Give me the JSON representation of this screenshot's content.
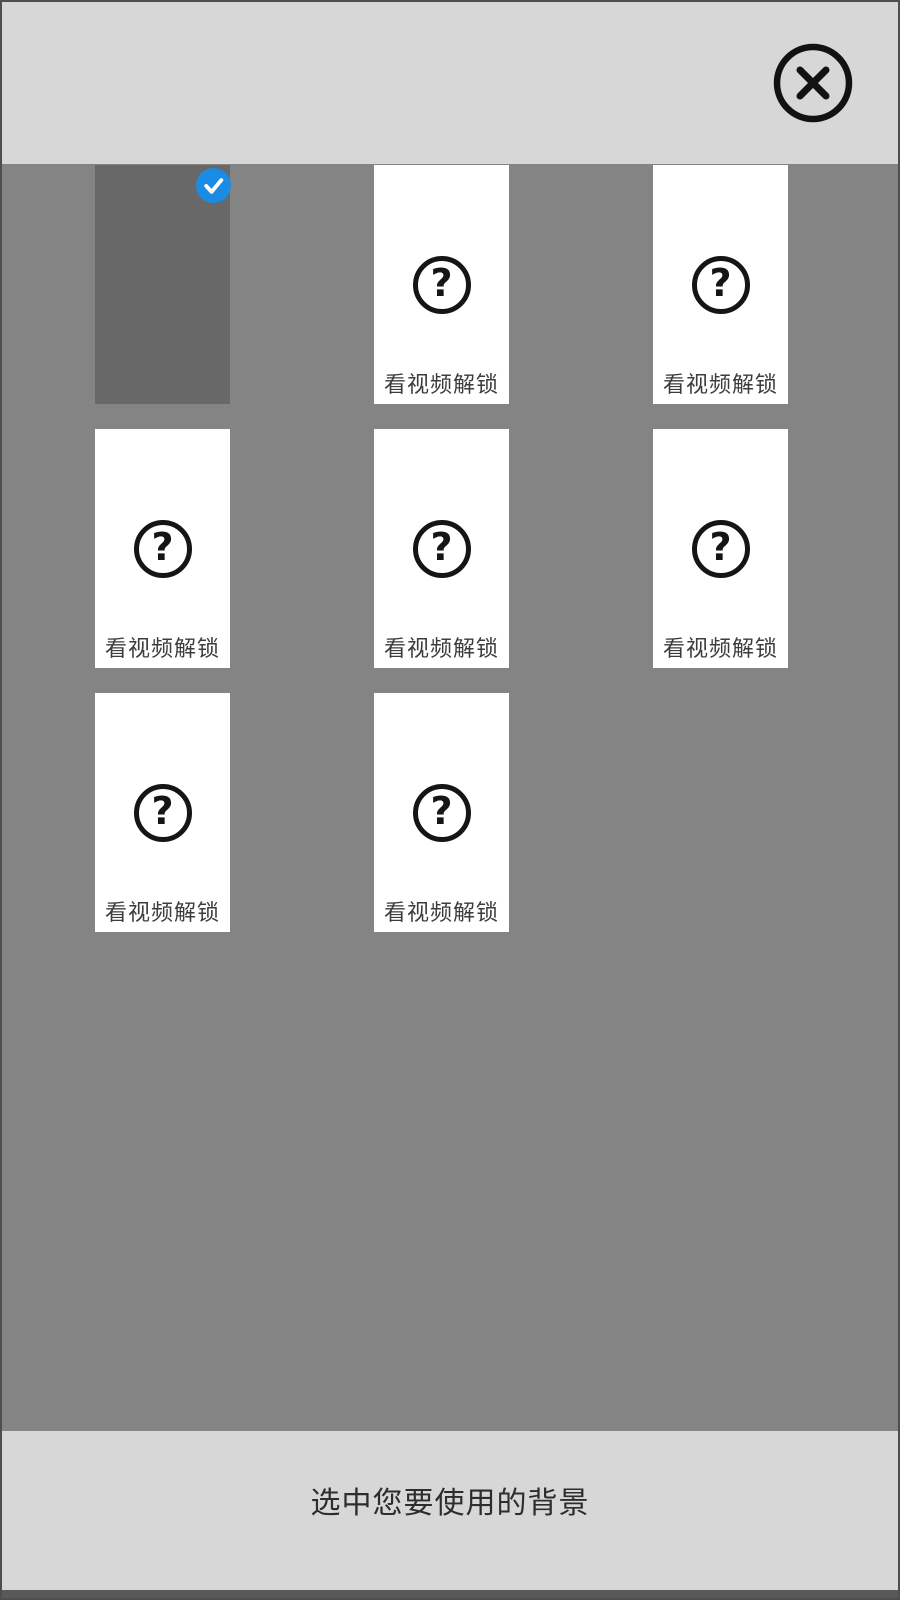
{
  "dialog": {
    "grid": {
      "locked_label": "看视频解锁",
      "question_glyph": "?",
      "items": [
        {
          "state": "selected"
        },
        {
          "state": "locked"
        },
        {
          "state": "locked"
        },
        {
          "state": "locked"
        },
        {
          "state": "locked"
        },
        {
          "state": "locked"
        },
        {
          "state": "locked"
        },
        {
          "state": "locked"
        }
      ]
    },
    "footer": {
      "caption": "选中您要使用的背景"
    },
    "colors": {
      "accent_blue": "#1b8ce4",
      "bar_gray": "#d7d7d7",
      "body_gray": "#848484",
      "selected_card_gray": "#686868",
      "icon_black": "#151515",
      "frame_border": "#4e4e4e"
    }
  }
}
